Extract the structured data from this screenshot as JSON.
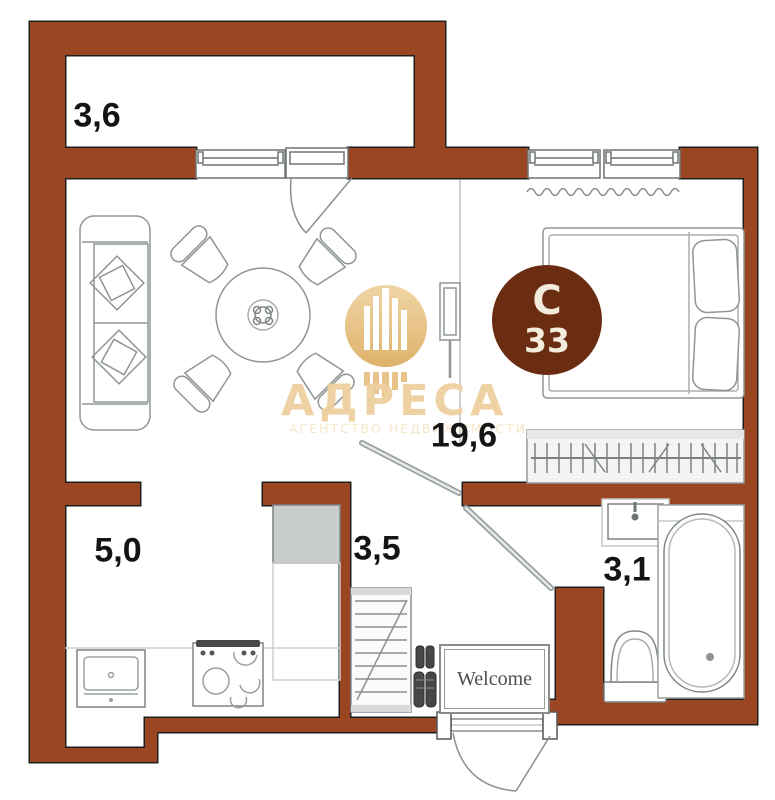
{
  "rooms": {
    "balcony": {
      "area": "3,6"
    },
    "living_room": {
      "area": "19,6"
    },
    "kitchen": {
      "area": "5,0"
    },
    "hallway": {
      "area": "3,5"
    },
    "bathroom": {
      "area": "3,1"
    }
  },
  "unit_badge": {
    "letter": "С",
    "number": "33"
  },
  "entrance": {
    "mat_text": "Welcome"
  },
  "watermark": {
    "title": "АДРЕСА",
    "subtitle": "АГЕНТСТВО НЕДВИЖИМОСТИ",
    "logo": "building-bars-icon"
  },
  "colors": {
    "wall": "#9A4622",
    "badge": "#6B2D12",
    "watermark_gold": "#E2B267",
    "watermark_text": "#EFD0A0"
  }
}
